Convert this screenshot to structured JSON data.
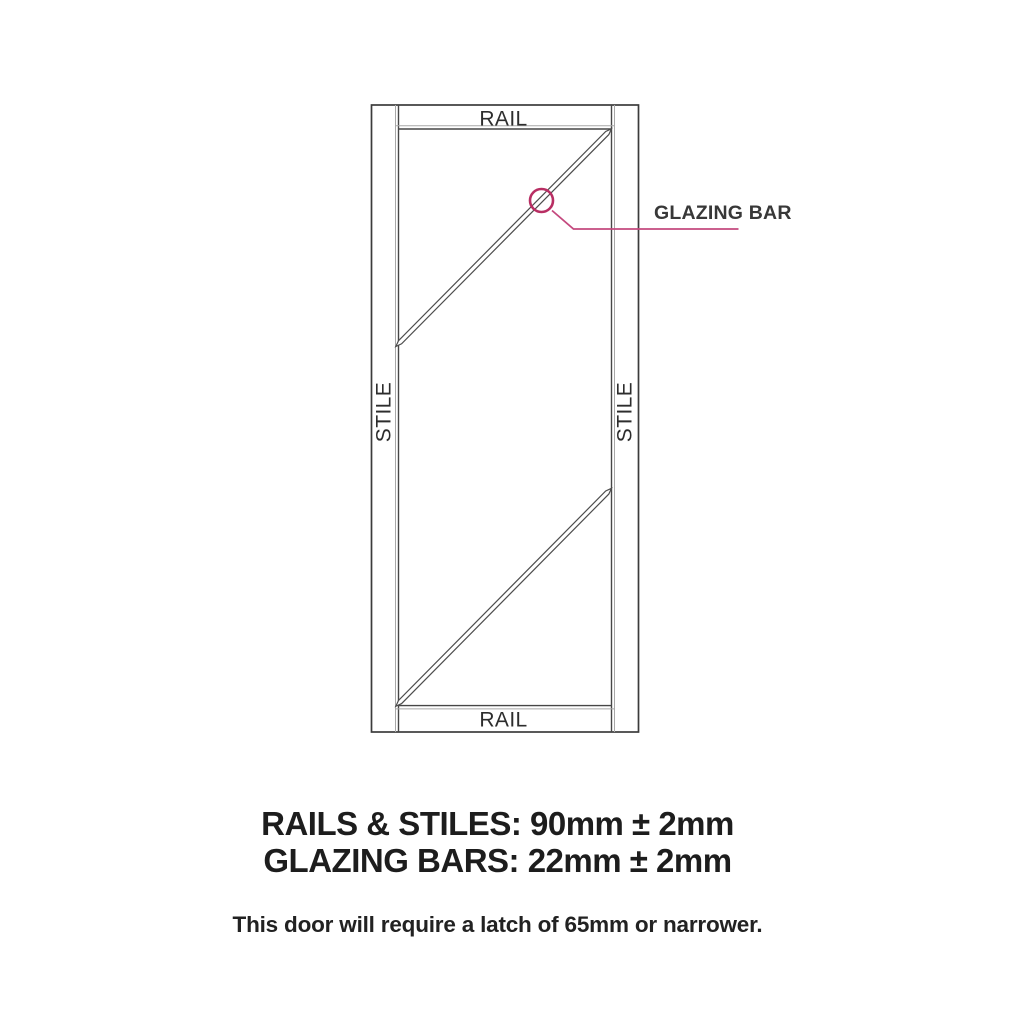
{
  "diagram": {
    "labels": {
      "rail_top": "RAIL",
      "rail_bottom": "RAIL",
      "stile_left": "STILE",
      "stile_right": "STILE",
      "glazing_bar": "GLAZING BAR"
    },
    "colors": {
      "line_dark": "#3c3c3c",
      "line_light": "#a8a8a8",
      "callout_line": "#c4497e",
      "callout_circle": "#b82e63",
      "label_text": "#2d2d2d"
    }
  },
  "specs": {
    "rails_stiles": "RAILS & STILES: 90mm ± 2mm",
    "glazing_bars": "GLAZING BARS: 22mm ± 2mm"
  },
  "note": {
    "text": "This door will require a latch of 65mm or narrower."
  }
}
